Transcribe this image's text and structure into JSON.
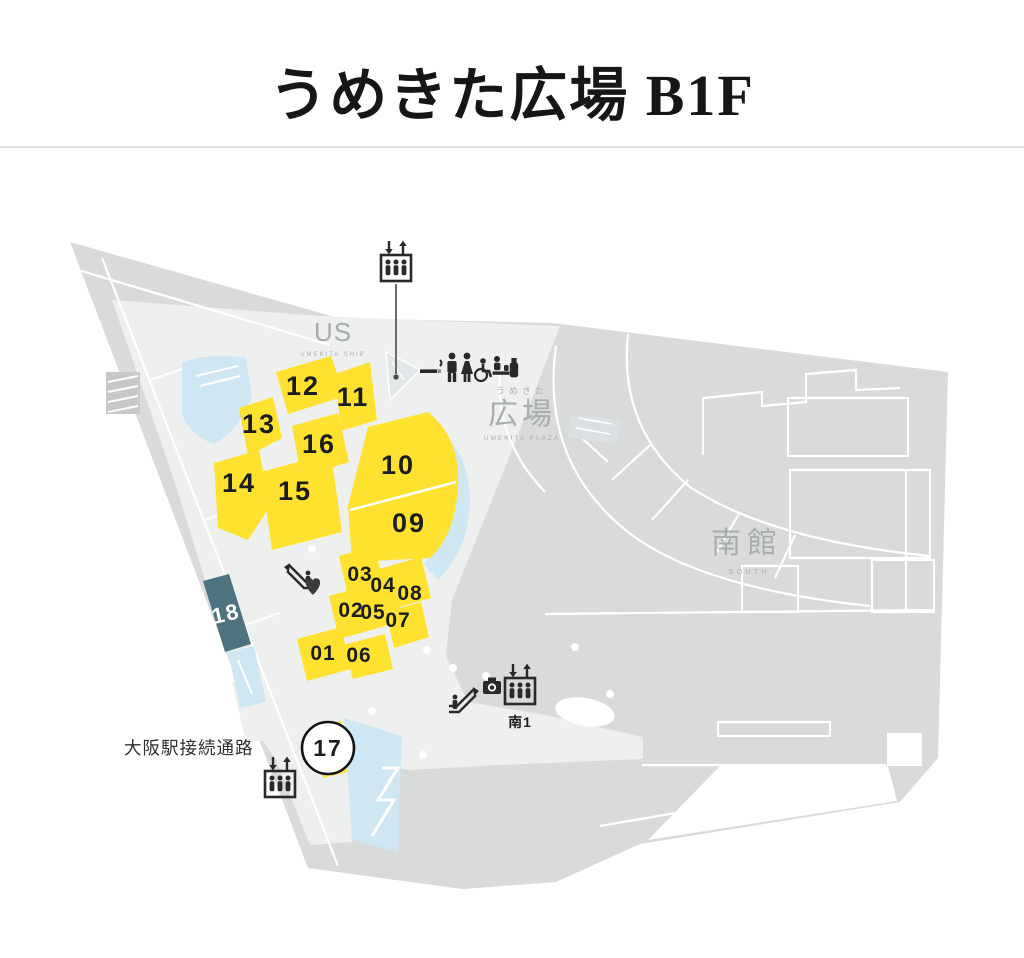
{
  "page": {
    "title": "うめきた広場 B1F"
  },
  "theme": {
    "yellow": "#ffe22f",
    "teal": "#4d7380",
    "water": "#cfe6f3",
    "floor": "#d9dada",
    "walkway": "#eef0ef",
    "ink": "#1c1c1e",
    "gray-text": "#aaadae",
    "icon": "#29292b"
  },
  "map": {
    "labels": {
      "us": {
        "text": "US",
        "sub": "UMEKITA SHIP"
      },
      "hiroba": {
        "kana": "うめきた",
        "text": "広場",
        "sub": "UMEKITA PLAZA"
      },
      "minamikan": {
        "text": "南館",
        "sub": "SOUTH"
      },
      "passage": {
        "text": "大阪駅接続通路"
      },
      "gate": {
        "text": "南1"
      }
    },
    "shop_numbers": [
      "01",
      "02",
      "03",
      "04",
      "05",
      "06",
      "07",
      "08",
      "09",
      "10",
      "11",
      "12",
      "13",
      "14",
      "15",
      "16",
      "17",
      "18"
    ],
    "icons": [
      "elevator-icon",
      "escalator-icon",
      "smoking-icon",
      "mens-toilet-icon",
      "womens-toilet-icon",
      "accessible-toilet-icon",
      "baby-room-icon",
      "vending-icon",
      "camera-icon",
      "heart-icon"
    ]
  }
}
